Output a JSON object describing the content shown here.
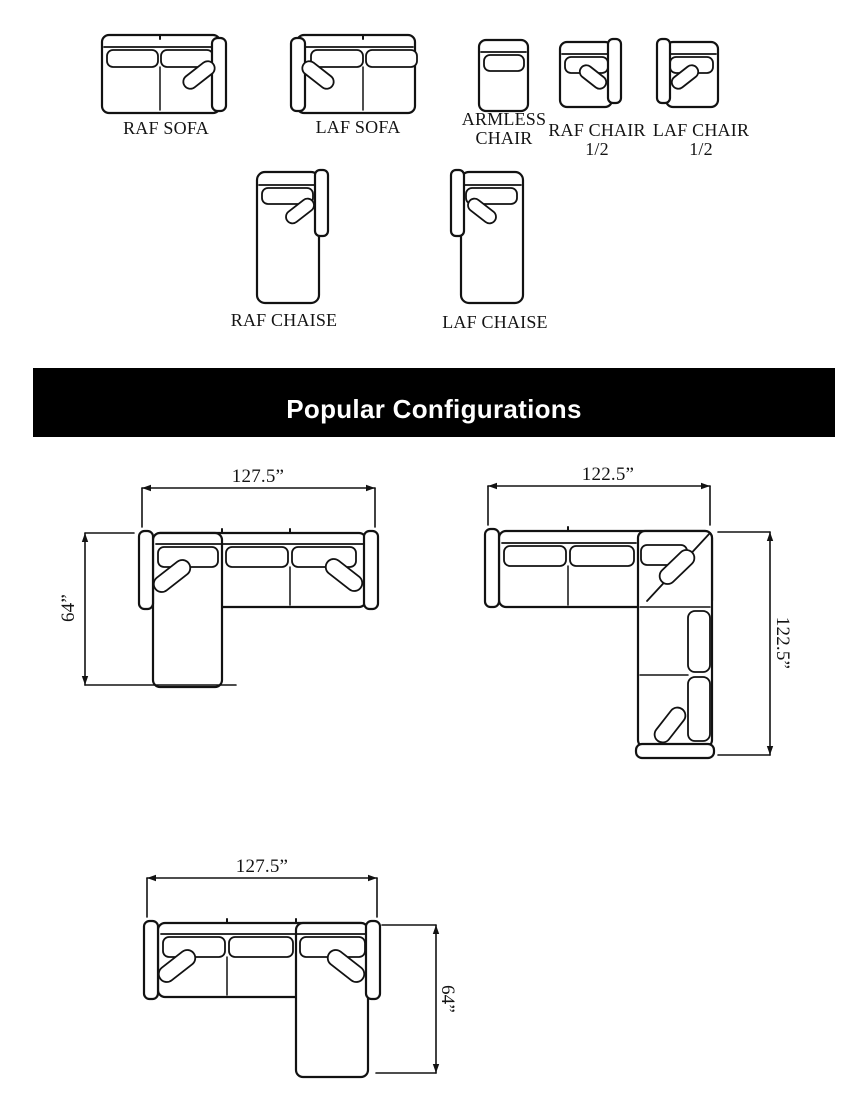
{
  "page": {
    "bg": "#ffffff",
    "ink": "#121212"
  },
  "catalog": {
    "modules": [
      {
        "label": "RAF SOFA"
      },
      {
        "label": "LAF SOFA"
      },
      {
        "label": "ARMLESS CHAIR"
      },
      {
        "label": "RAF CHAIR 1/2"
      },
      {
        "label": "LAF CHAIR 1/2"
      },
      {
        "label": "RAF CHAISE"
      },
      {
        "label": "LAF CHAISE"
      }
    ]
  },
  "banner": {
    "title": "Popular Configurations",
    "bg": "#000000",
    "text_color": "#ffffff"
  },
  "configurations": [
    {
      "width_label": "127.5”",
      "depth_label": "64”"
    },
    {
      "width_label": "122.5”",
      "depth_label": "122.5”"
    },
    {
      "width_label": "127.5”",
      "depth_label": "64”"
    }
  ]
}
